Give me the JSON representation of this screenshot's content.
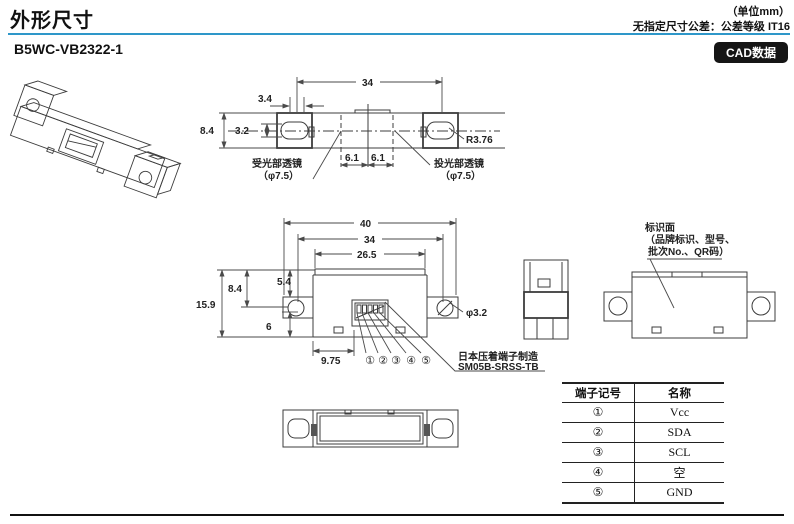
{
  "header": {
    "title": "外形尺寸",
    "unit_note": "（单位mm）",
    "tolerance_note": "无指定尺寸公差：公差等级 IT16",
    "accent_color": "#2e97c9"
  },
  "product": {
    "model": "B5WC-VB2322-1",
    "cad_button": "CAD数据"
  },
  "top_view": {
    "d34": "34",
    "d3_4": "3.4",
    "d8_4": "8.4",
    "d3_2": "3.2",
    "d6_1a": "6.1",
    "d6_1b": "6.1",
    "radius": "R3.76",
    "receiver_label": "受光部透镜",
    "receiver_dia": "（φ7.5）",
    "emitter_label": "投光部透镜",
    "emitter_dia": "（φ7.5）"
  },
  "front_view": {
    "d40": "40",
    "d34": "34",
    "d26_5": "26.5",
    "d15_9": "15.9",
    "d8_4": "8.4",
    "d5_4": "5.4",
    "d6": "6",
    "d9_75": "9.75",
    "hole": "φ3.2",
    "pins": [
      "①",
      "②",
      "③",
      "④",
      "⑤"
    ],
    "connector_maker": "日本压着端子制造",
    "connector_model": "SM05B-SRSS-TB"
  },
  "back_view": {
    "label_line1": "标识面",
    "label_line2": "（品牌标识、型号、",
    "label_line3": "批次No.、QR码）"
  },
  "pin_table": {
    "col1": "端子记号",
    "col2": "名称",
    "rows": [
      [
        "①",
        "Vcc"
      ],
      [
        "②",
        "SDA"
      ],
      [
        "③",
        "SCL"
      ],
      [
        "④",
        "空"
      ],
      [
        "⑤",
        "GND"
      ]
    ]
  }
}
